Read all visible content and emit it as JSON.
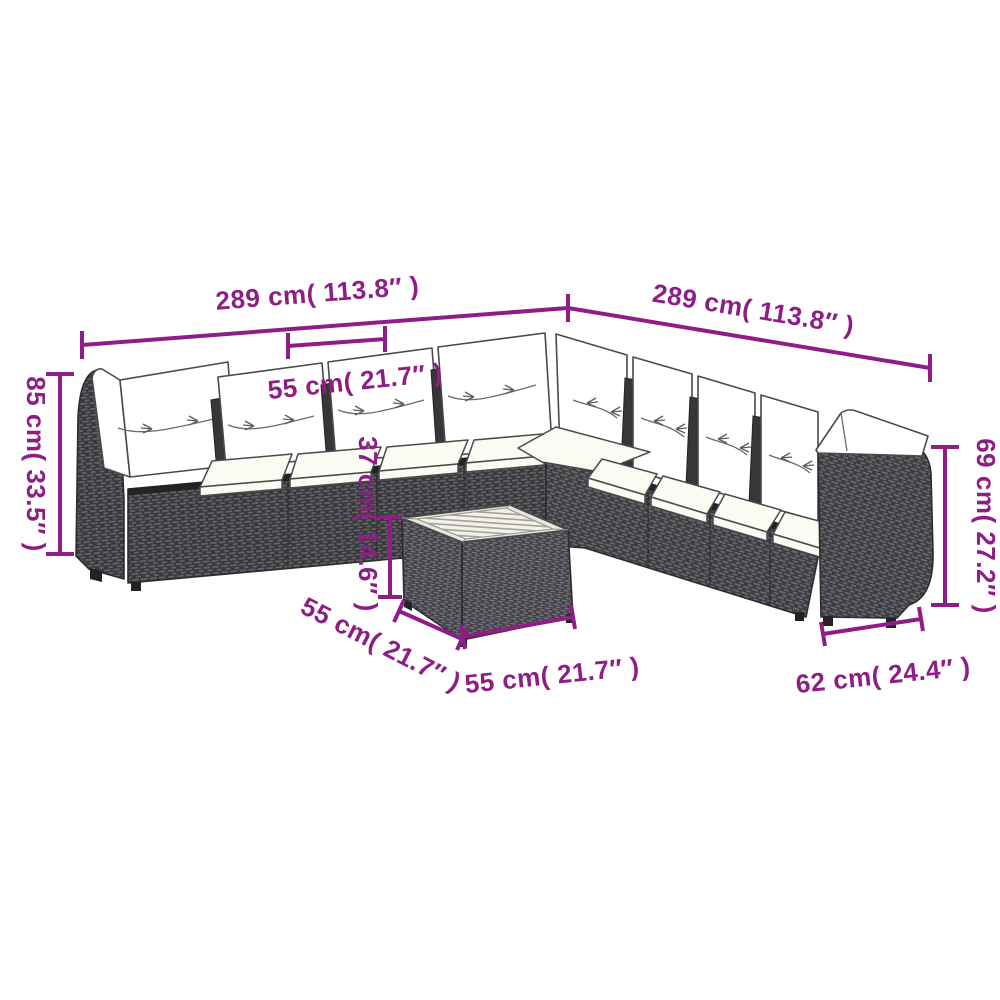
{
  "accent_color": "#8E1E86",
  "illustration": {
    "description": "Line-art drawing of an L-shaped poly rattan garden sofa set with white cushions and a square coffee table with slatted wood top",
    "rattan_color": "#3a3a3d",
    "cushion_color": "#ffffff"
  },
  "dimensions": {
    "sofa_left_width": {
      "label": "289 cm( 113.8″ )"
    },
    "sofa_right_width": {
      "label": "289 cm( 113.8″ )"
    },
    "seat_module_width": {
      "label": "55 cm( 21.7″ )"
    },
    "backrest_height": {
      "label": "85 cm( 33.5″ )"
    },
    "table_height": {
      "label": "37 cm( 14.6″ )"
    },
    "table_depth": {
      "label": "55 cm( 21.7″ )"
    },
    "table_width": {
      "label": "55 cm( 21.7″ )"
    },
    "armrest_height": {
      "label": "69 cm( 27.2″ )"
    },
    "seat_module_depth": {
      "label": "62 cm( 24.4″ )"
    }
  }
}
